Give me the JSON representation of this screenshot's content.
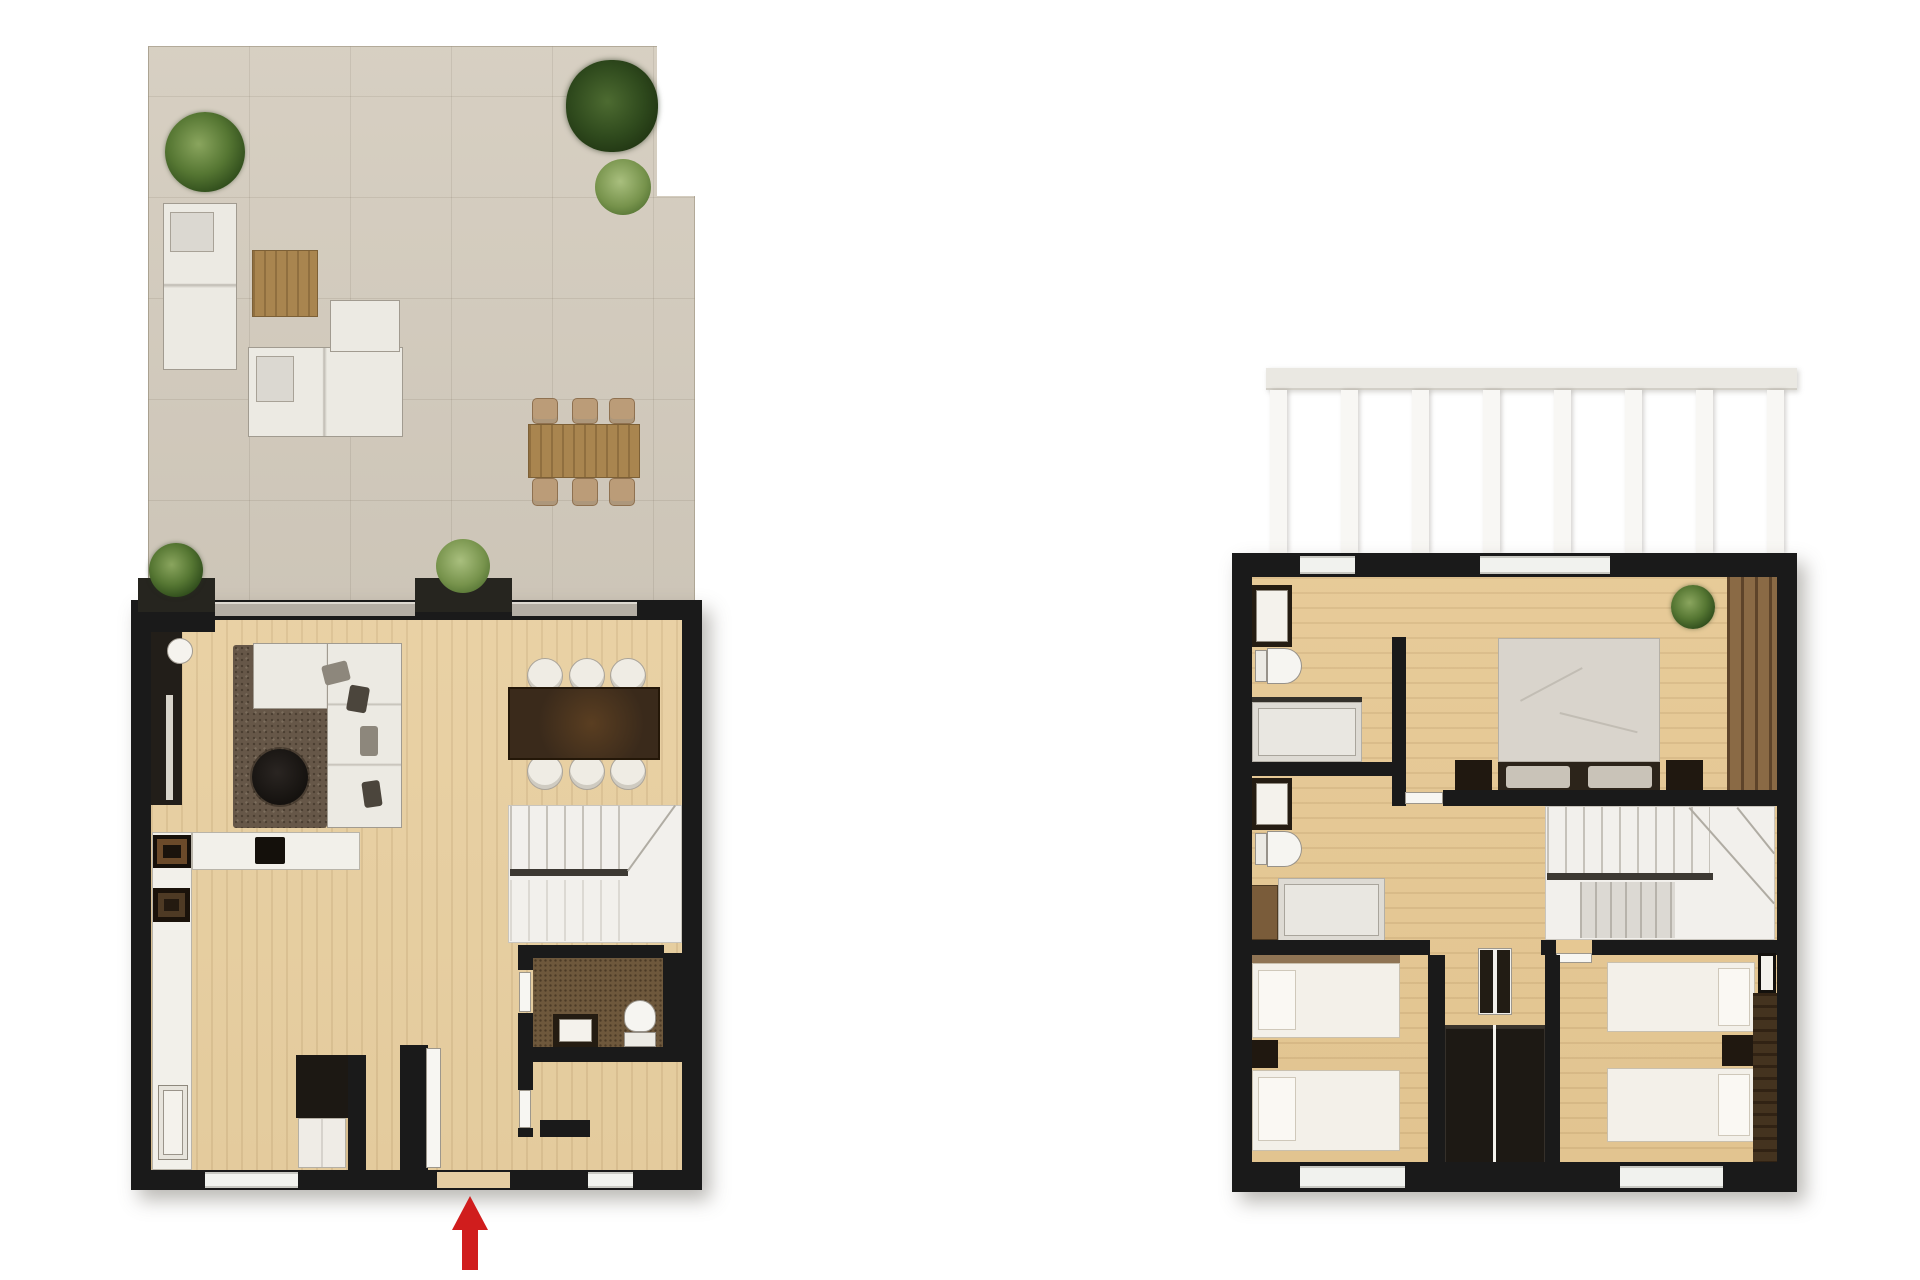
{
  "document": {
    "type": "floor-plan-render",
    "visible_text": [],
    "plans_count": 2
  },
  "colors": {
    "background": "#ffffff",
    "wall": "#1a1a1a",
    "terrace_tile": "#d5cdbf",
    "wood_floor": "#e8cfa0",
    "dark_wood": "#3a2a1b",
    "white_furniture": "#f2f0ea",
    "rug_brown": "#665748",
    "plant_green": "#2d4a1a",
    "arrow_red": "#d01d1d"
  },
  "ground_floor": {
    "name": "ground-floor-plan",
    "terrace": {
      "floor_material": "stone-tiles",
      "plants_count": 5,
      "furniture": [
        "corner-sofa",
        "lounge-sofa",
        "ottoman",
        "wood-coffee-table",
        "outdoor-dining-table",
        "outdoor-chairs-x6",
        "planter-box-x2"
      ]
    },
    "interior": {
      "rooms": [
        "living-area",
        "dining-area",
        "kitchen",
        "staircase",
        "bathroom",
        "hallway",
        "storage-room",
        "entrance"
      ],
      "furniture": [
        "sectional-sofa",
        "area-rug",
        "round-coffee-table",
        "tv-media-panel",
        "floor-lamp",
        "dining-table",
        "dining-chairs-x6",
        "kitchen-wall-counter",
        "kitchen-island",
        "cooktop",
        "oven",
        "kitchen-sink",
        "bathroom-vanity",
        "toilet",
        "entrance-wardrobe"
      ]
    },
    "entrance_arrow": {
      "direction": "up",
      "color": "#d01d1d"
    }
  },
  "upper_floor": {
    "name": "upper-floor-plan",
    "exterior": {
      "pergola_slats_count": 8
    },
    "rooms": [
      "bathroom-1",
      "bathroom-2",
      "master-bedroom",
      "bedroom-2",
      "bedroom-3",
      "staircase",
      "landing"
    ],
    "furniture": [
      "double-bed",
      "single-bed-x4",
      "nightstand-x4",
      "built-in-wardrobe-pair",
      "wardrobe-band-x2",
      "shower-x2",
      "toilet-x2",
      "vanity-x2",
      "duct-shaft",
      "potted-plant"
    ]
  }
}
